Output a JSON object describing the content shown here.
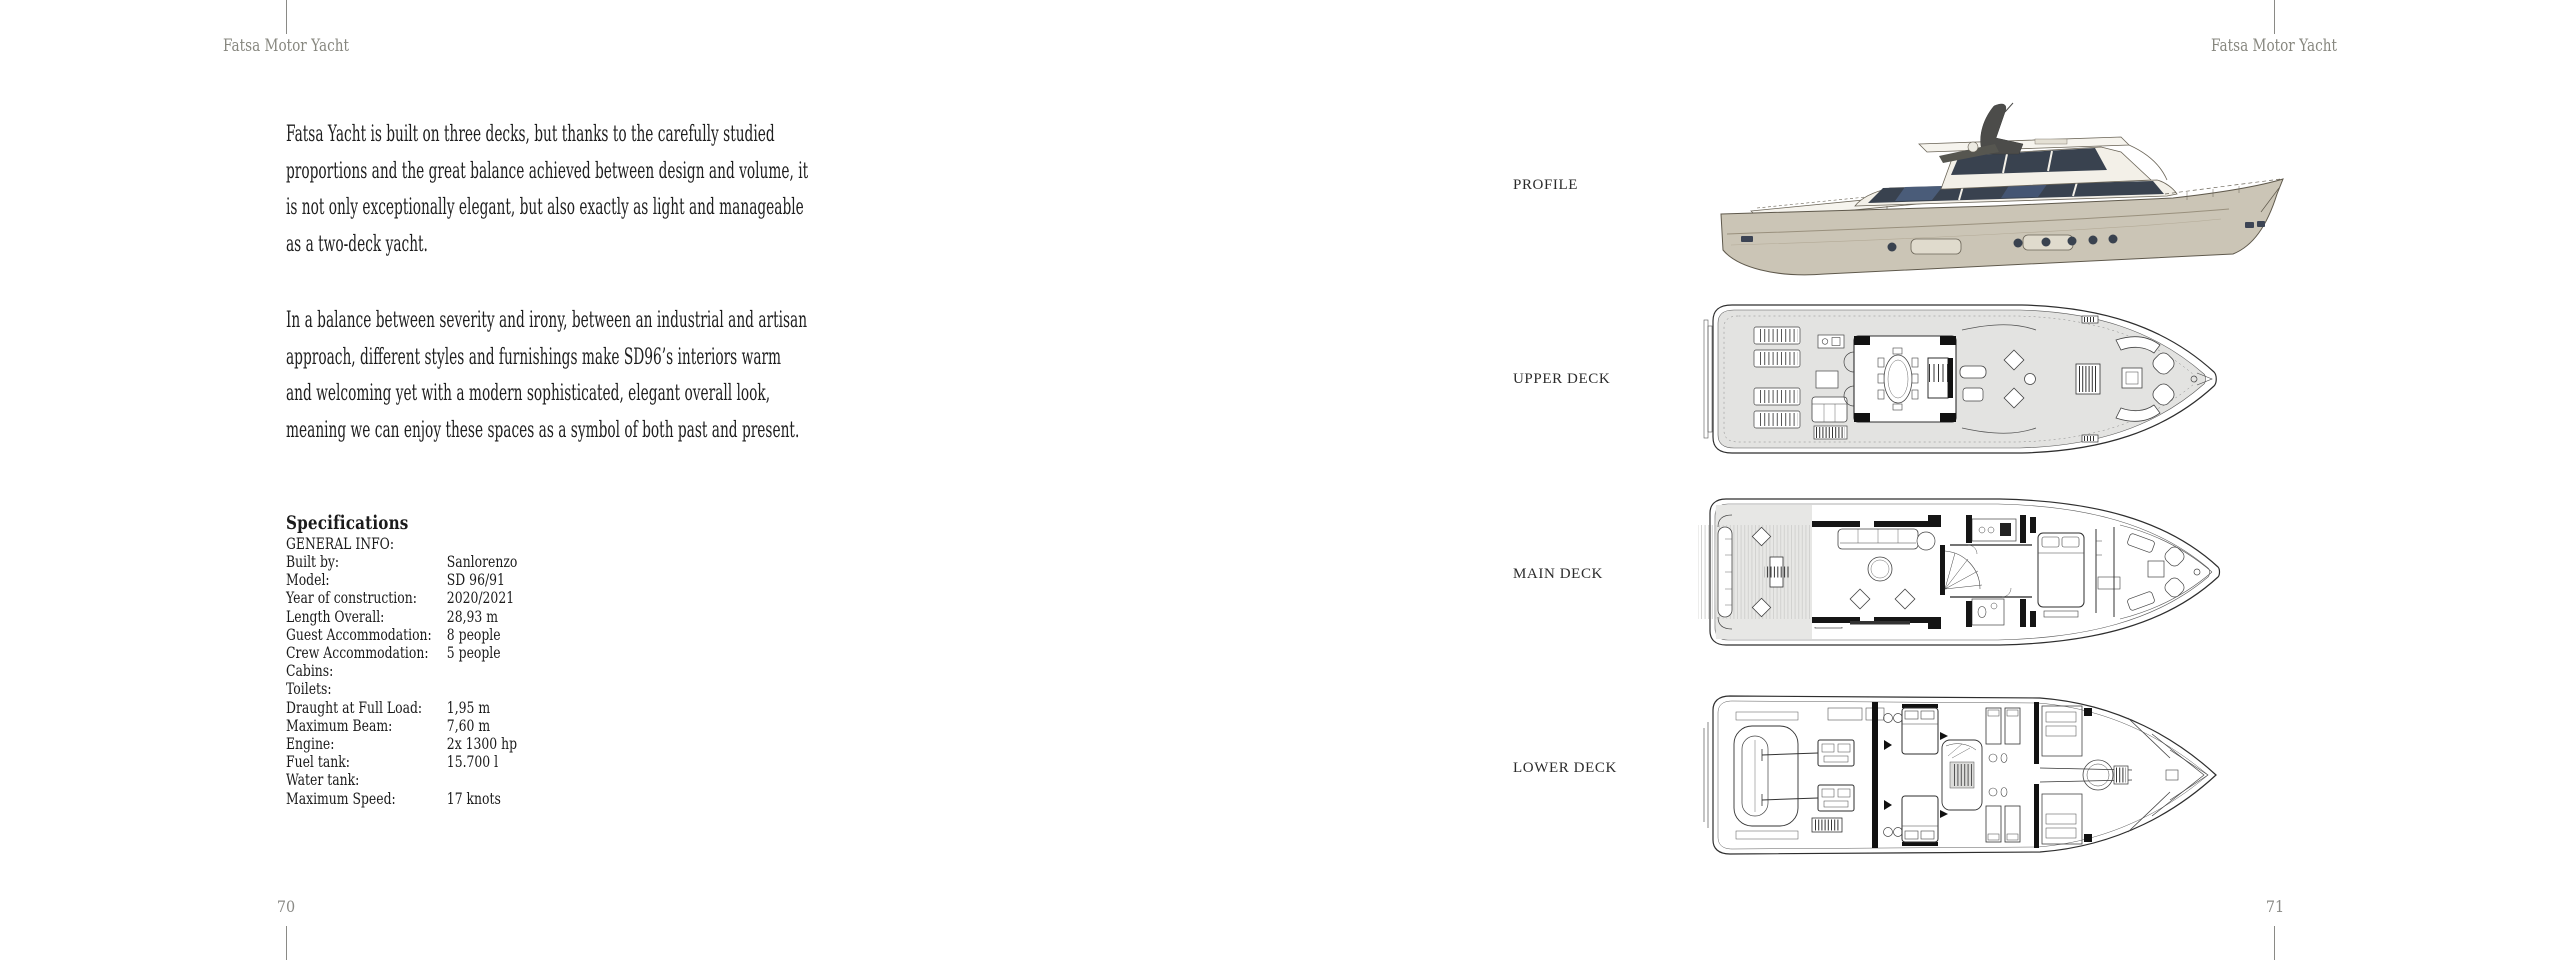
{
  "left_page": {
    "header": "Fatsa Motor Yacht",
    "page_number": "70",
    "paragraphs": [
      {
        "lines": [
          "Fatsa Yacht is built on three decks, but thanks to the carefully studied",
          "proportions and the great balance achieved between design and volume, it",
          "is not only exceptionally elegant, but also exactly as light and manageable",
          "as a two-deck yacht."
        ]
      },
      {
        "lines": [
          "In a balance between severity and irony, between an industrial and artisan",
          "approach, different styles and furnishings make SD96’s interiors warm",
          "and welcoming yet with a modern sophisticated, elegant overall look,",
          "meaning we can enjoy these spaces as a symbol of both past and present."
        ]
      }
    ],
    "specifications": {
      "title": "Specifications",
      "section": "GENERAL INFO:",
      "rows": [
        {
          "label": "Built by:",
          "value": "Sanlorenzo"
        },
        {
          "label": "Model:",
          "value": "SD 96/91"
        },
        {
          "label": "Year of construction:",
          "value": "2020/2021"
        },
        {
          "label": "Length Overall:",
          "value": "28,93 m"
        },
        {
          "label": "Guest Accommodation:",
          "value": "8 people"
        },
        {
          "label": "Crew Accommodation:",
          "value": "5 people"
        },
        {
          "label": "Cabins:",
          "value": ""
        },
        {
          "label": "Toilets:",
          "value": ""
        },
        {
          "label": "Draught at Full Load:",
          "value": "1,95 m"
        },
        {
          "label": "Maximum Beam:",
          "value": "7,60 m"
        },
        {
          "label": "Engine:",
          "value": "2x 1300 hp"
        },
        {
          "label": "Fuel tank:",
          "value": "15.700 l"
        },
        {
          "label": "Water tank:",
          "value": ""
        },
        {
          "label": "Maximum Speed:",
          "value": "17 knots"
        }
      ]
    }
  },
  "right_page": {
    "header": "Fatsa Motor Yacht",
    "page_number": "71",
    "views": [
      {
        "label": "PROFILE"
      },
      {
        "label": "UPPER DECK"
      },
      {
        "label": "MAIN DECK"
      },
      {
        "label": "LOWER DECK"
      }
    ]
  },
  "colors": {
    "hull_beige": "#cbc5b6",
    "glass_dark": "#39424f",
    "superstructure": "#f3f0e8",
    "deck_plan_fill": "#e3e3e1",
    "plan_line": "#2e2e2e",
    "muted_gray": "#8a8a86",
    "text": "#1e1e1e"
  }
}
